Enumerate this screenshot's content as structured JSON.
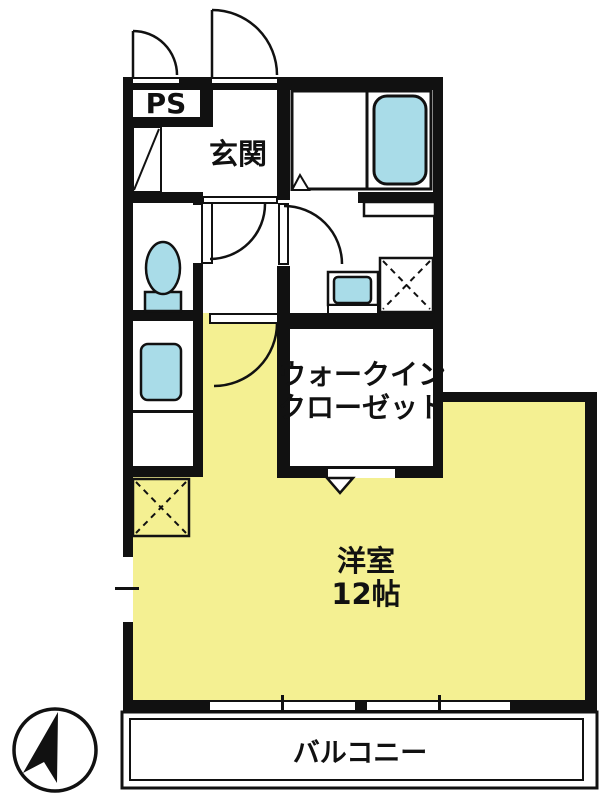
{
  "plan": {
    "labels": {
      "ps": "PS",
      "entrance": "玄関",
      "closet_line1": "ウォークイン",
      "closet_line2": "クローゼット",
      "room_name": "洋室",
      "room_size": "12帖",
      "balcony": "バルコニー"
    },
    "colors": {
      "room": "#F4F092",
      "fixture": "#A9DCE8",
      "wall": "#111111",
      "background": "#FFFFFF"
    }
  }
}
